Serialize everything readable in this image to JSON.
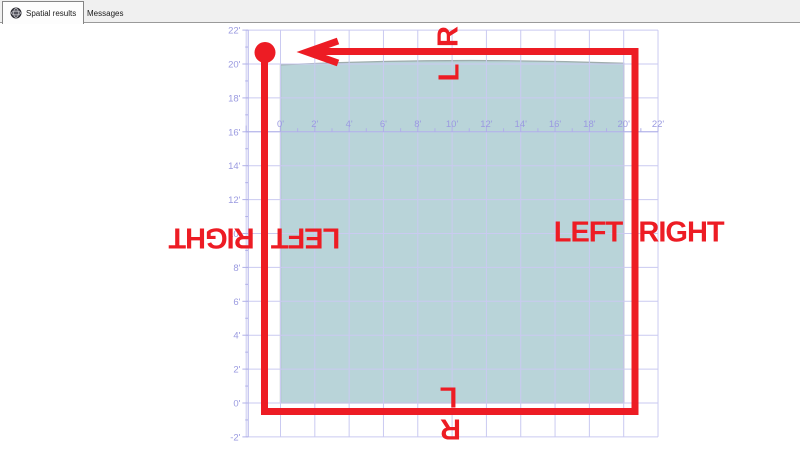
{
  "tabs": [
    {
      "label": "Spatial results",
      "icon": "globe-icon",
      "active": true
    },
    {
      "label": "Messages",
      "icon": "messages-icon",
      "active": false
    }
  ],
  "plot": {
    "x_axis_labels": [
      "0'",
      "2'",
      "4'",
      "6'",
      "8'",
      "10'",
      "12'",
      "14'",
      "16'",
      "18'",
      "20'",
      "22'"
    ],
    "x_axis_feet": [
      0,
      2,
      4,
      6,
      8,
      10,
      12,
      14,
      16,
      18,
      20,
      22
    ],
    "y_axis_labels": [
      "22'",
      "20'",
      "18'",
      "16'",
      "14'",
      "12'",
      "10'",
      "8'",
      "6'",
      "4'",
      "2'",
      "0'",
      "-2'"
    ],
    "y_axis_feet": [
      22,
      20,
      18,
      16,
      14,
      12,
      10,
      8,
      6,
      4,
      2,
      0,
      -2
    ],
    "gridline_feet": [
      -2,
      0,
      2,
      4,
      6,
      8,
      10,
      12,
      14,
      16,
      18,
      20,
      22
    ],
    "shape": {
      "type": "polygon",
      "x_min_ft": 0,
      "x_max_ft": 20,
      "y_min_ft": 0,
      "y_max_ft": 20
    }
  },
  "annotations": {
    "top_outside": "R",
    "top_inside": "L",
    "bottom_inside": "L",
    "bottom_outside": "R",
    "left_outside": "RIGHT",
    "left_inside": "LEFT",
    "right_inside": "LEFT",
    "right_outside": "RIGHT"
  },
  "colors": {
    "annotation": "#ED1C24",
    "grid": "#cacaf1",
    "axis": "#b0b0e8",
    "tick_label": "#9a9ae0",
    "polygon_fill": "#b9d4d9",
    "polygon_stroke": "#9fadac",
    "tab_strip_bg": "#f0f0f0"
  }
}
